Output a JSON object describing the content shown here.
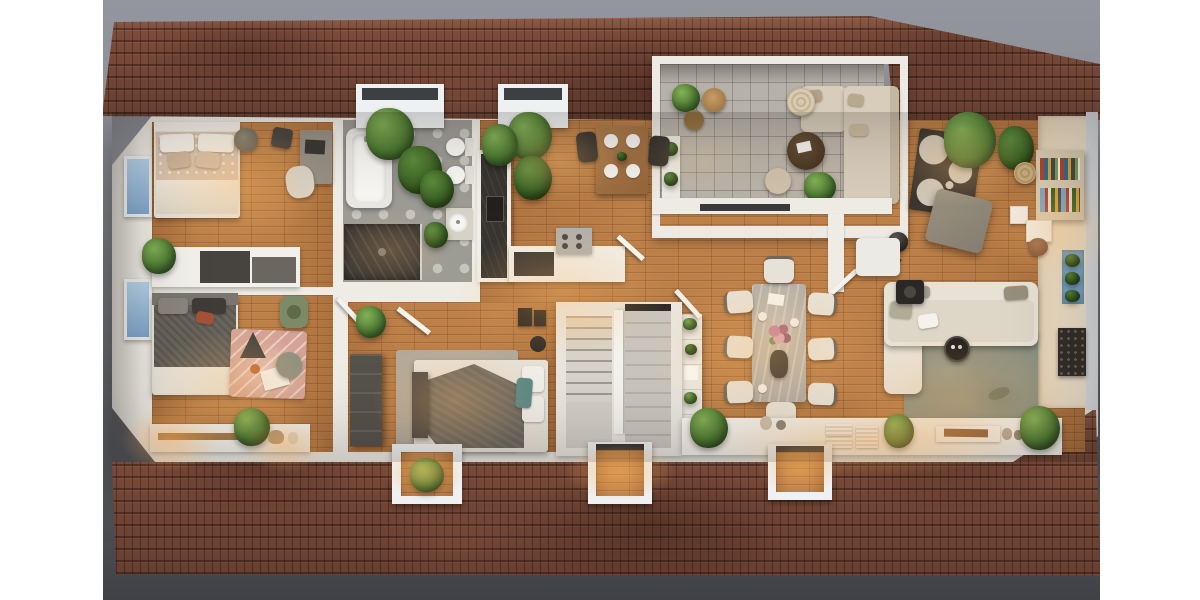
{
  "scene": {
    "type": "3d-dollhouse-floor-plan-render",
    "view": "top-down",
    "lighting": "warm-evening-interior",
    "background_top": "#94969f",
    "background_bottom": "#3f4146",
    "letterbox_color": "#ffffff"
  },
  "palette": {
    "roof": "#7c4c3b",
    "roofShade": "#56352a",
    "wall": "#efece5",
    "wallShade": "#ddd9d1",
    "wood": "#bd8049",
    "woodDark": "#93592b",
    "bathTile": "#9c9b94",
    "bathTileLight": "#c6c4bc",
    "terraceTile": "#b6b2aa",
    "stair": "#d7d3cb",
    "stairDark": "#c9c5bd",
    "window": "#a9c8e6",
    "plant": "#4e7a33",
    "plantDark": "#3c6124",
    "glow": "#ffb15e",
    "cream": "#ecdcc2",
    "sofaCream": "#e8e2d6",
    "sage": "#8d9282",
    "charcoal": "#33302c",
    "marble": "#b9b4ab",
    "pinkRug": "#d4a395",
    "terracottaPot": "#b28a58"
  },
  "building": {
    "roof_material": "terracotta-tiles",
    "roof_slopes": 2,
    "dormers_top": 2,
    "dormers_bottom": 3,
    "west_windows": 2,
    "terrace": "open-roof-terrace",
    "stair_flights": 2
  },
  "rooms": [
    {
      "name": "master-bedroom",
      "position": "top-left",
      "furniture": [
        "double-bed",
        "white-pillows",
        "patterned-duvet",
        "round-side-table",
        "desk",
        "desk-chair",
        "sideboard-dresser",
        "potted-plant",
        "west-window"
      ]
    },
    {
      "name": "bathroom",
      "position": "top-center-left",
      "furniture": [
        "bathtub",
        "walk-in-shower",
        "wall-hung-toilet",
        "wall-hung-bidet",
        "round-washbasin",
        "dormer-plants"
      ]
    },
    {
      "name": "kitchen",
      "position": "center",
      "furniture": [
        "l-shaped-counter",
        "dark-stone-worktop",
        "inset-sink",
        "cooktop-unit",
        "breakfast-table",
        "two-black-chairs",
        "four-place-settings",
        "corner-plants"
      ]
    },
    {
      "name": "dining-area",
      "position": "center-right",
      "furniture": [
        "stone-dining-table",
        "eight-upholstered-chairs",
        "flower-centerpiece",
        "dark-vase",
        "plant-etagere",
        "open-door"
      ]
    },
    {
      "name": "living-area",
      "position": "right",
      "furniture": [
        "cream-corner-sofa",
        "sage-area-rug",
        "robot-vacuum",
        "arc-floor-lamp",
        "white-cube-side-table",
        "dark-fire-table",
        "lit-console-shelf"
      ]
    },
    {
      "name": "tv-lounge",
      "position": "top-right",
      "furniture": [
        "dark-circle-pattern-rug",
        "gray-ottoman",
        "bookshelf-with-colorful-books",
        "white-side-tables",
        "jute-pouf",
        "blue-planter",
        "tall-plants",
        "dark-wall-panel"
      ]
    },
    {
      "name": "terrace",
      "position": "top-center-right",
      "furniture": [
        "outdoor-corner-sofa",
        "round-dark-coffee-table",
        "woven-pouf",
        "beige-pouf",
        "topiary-plant",
        "log-stools",
        "white-planter-box",
        "sliding-door"
      ]
    },
    {
      "name": "kids-bedroom",
      "position": "bottom-left",
      "furniture": [
        "bed-dark-knit-throw",
        "blush-play-rug",
        "play-teepee",
        "round-pouf",
        "sage-kids-chair",
        "low-wall-shelf",
        "plants",
        "west-window"
      ]
    },
    {
      "name": "third-bedroom",
      "position": "bottom-center",
      "furniture": [
        "double-bed-gray-throw",
        "teal-pillows",
        "foot-bench",
        "dark-wardrobe",
        "speaker-boxes",
        "gray-rug",
        "open-door",
        "plant"
      ]
    },
    {
      "name": "staircase",
      "position": "center-bottom",
      "furniture": [
        "tread-flight",
        "return-flight",
        "center-wall",
        "landing"
      ]
    },
    {
      "name": "hallway-console",
      "position": "bottom",
      "furniture": [
        "long-lit-shelf",
        "plants",
        "vases",
        "ribbed-storage-boxes",
        "serving-tray"
      ]
    }
  ]
}
